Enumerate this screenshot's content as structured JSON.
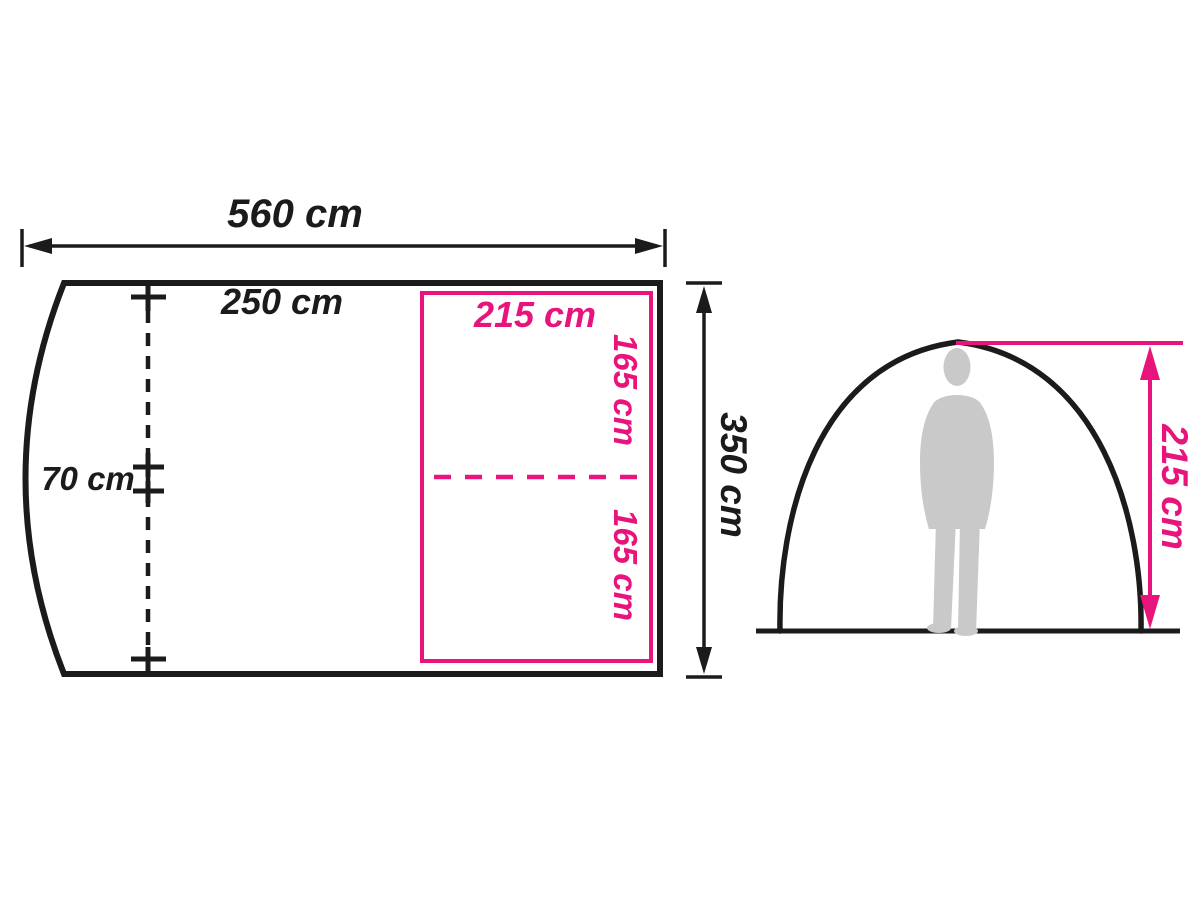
{
  "title": "Tent dimensions diagram",
  "colors": {
    "line": "#1b1b1b",
    "accent": "#e8147c",
    "silhouette": "#c9c9c9",
    "background": "#ffffff"
  },
  "floor_plan": {
    "total_width": "560 cm",
    "front_width": "250 cm",
    "porch_depth": "70 cm",
    "inner_width": "215 cm",
    "inner_depth_front": "165 cm",
    "inner_depth_rear": "165 cm",
    "total_depth": "350 cm"
  },
  "side_view": {
    "peak_height": "215 cm"
  }
}
